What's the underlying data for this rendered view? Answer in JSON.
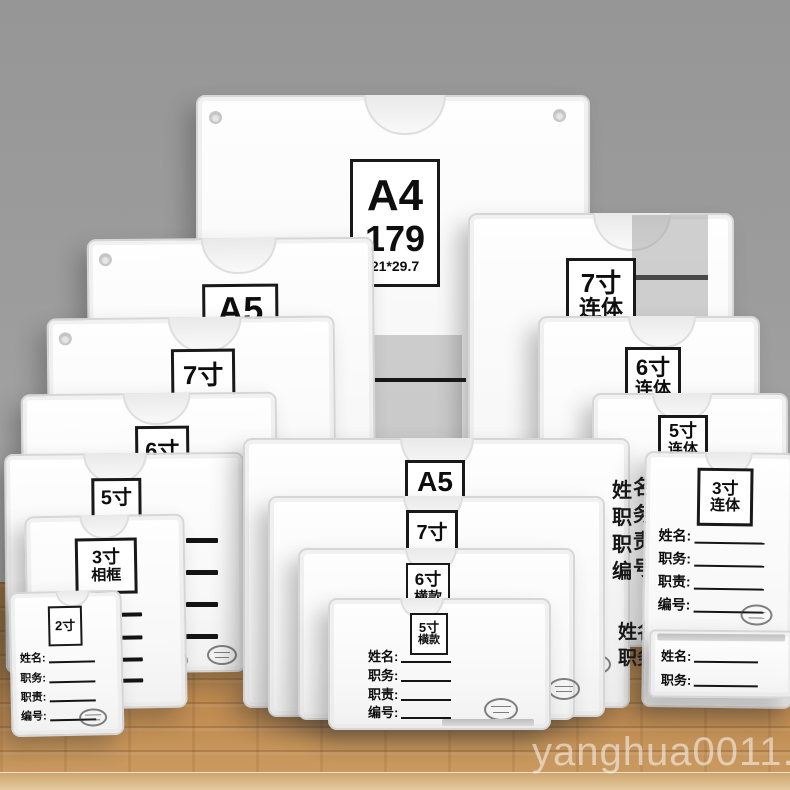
{
  "watermark": "yanghua0011.my",
  "a4": {
    "size": "A4",
    "price": "179",
    "dims": "21*29.7",
    "name": "姓名",
    "position": "职务"
  },
  "labels": {
    "left_a5": "A5",
    "left_7": "7寸",
    "left_6": "6寸",
    "left_5": "5寸",
    "left_3a": "3寸",
    "left_3b": "相框",
    "left_2": "2寸",
    "right_7a": "7寸",
    "right_7b": "连体",
    "right_6a": "6寸",
    "right_6b": "连体",
    "right_5a": "5寸",
    "right_5b": "连体",
    "right_3a": "3寸",
    "right_3b": "连体",
    "center_a5": "A5",
    "center_7": "7寸",
    "center_6a": "6寸",
    "center_6b": "横款",
    "center_5a": "5寸",
    "center_5b": "横款"
  },
  "fields": {
    "name": "姓名:",
    "position": "职务:",
    "duty": "职责:",
    "number": "编号:"
  },
  "side": {
    "col1": "姓职职编",
    "col2": "名务责号",
    "col3": "姓职",
    "col4": "名务"
  },
  "icons": {
    "stamp": "oval-stamp",
    "notch": "thumb-notch",
    "hole": "screw-hole"
  },
  "colors": {
    "wall": "#9d9d9d",
    "wood": "#b5834a",
    "frame": "#f7f7f7",
    "label_border": "#191919"
  }
}
